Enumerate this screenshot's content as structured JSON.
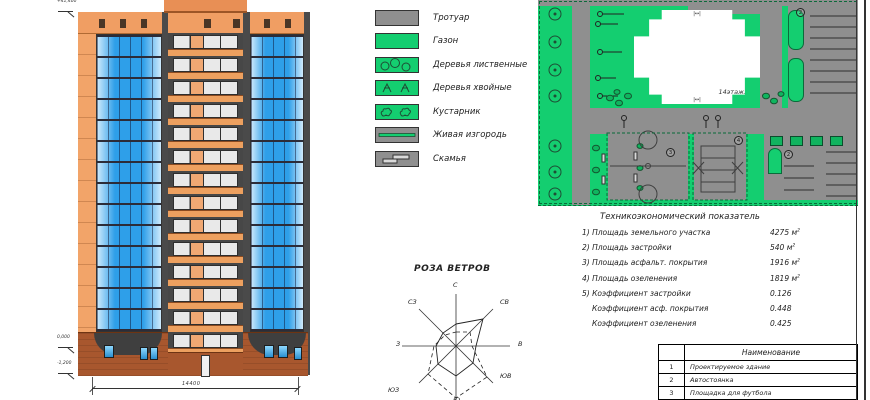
{
  "legend": {
    "items": [
      {
        "label": "Тротуар",
        "type": "sidewalk"
      },
      {
        "label": "Газон",
        "type": "lawn"
      },
      {
        "label": "Деревья лиственные",
        "type": "deciduous-trees"
      },
      {
        "label": "Деревья хвойные",
        "type": "conifer-trees"
      },
      {
        "label": "Кустарник",
        "type": "shrub"
      },
      {
        "label": "Живая изгородь",
        "type": "hedge"
      },
      {
        "label": "Скамья",
        "type": "bench"
      }
    ]
  },
  "site_plan": {
    "building_label": "14этаж.",
    "markers": {
      "parking_upper": "2",
      "parking_lower": "2",
      "field": "3",
      "court": "4"
    }
  },
  "wind_rose": {
    "title": "РОЗА ВЕТРОВ",
    "directions": {
      "n": "С",
      "ne": "СВ",
      "e": "В",
      "se": "ЮВ",
      "s": "Ю",
      "sw": "ЮЗ",
      "w": "З",
      "nw": "СЗ"
    }
  },
  "indicators": {
    "title": "Техникоэкономический показатель",
    "rows": [
      {
        "label": "1) Площадь земельного участка",
        "value": "4275 м",
        "sup": "2"
      },
      {
        "label": "2) Площадь застройки",
        "value": "540 м",
        "sup": "2"
      },
      {
        "label": "3) Площадь асфальт. покрытия",
        "value": "1916 м",
        "sup": "2"
      },
      {
        "label": "4) Площадь озеленения",
        "value": "1819 м",
        "sup": "2"
      },
      {
        "label": "5) Коэффициент застройки",
        "value": "0.126",
        "sup": ""
      },
      {
        "label": "Коэффициент асф. покрытия",
        "value": "0.448",
        "sup": ""
      },
      {
        "label": "Коэффициент озеленения",
        "value": "0.425",
        "sup": ""
      }
    ]
  },
  "schedule_table": {
    "header": "Наименование",
    "rows": [
      {
        "num": "1",
        "name": "Проектируемое здание"
      },
      {
        "num": "2",
        "name": "Автостоянка"
      },
      {
        "num": "3",
        "name": "Площадка для футбола"
      }
    ]
  },
  "elevation": {
    "dimension": "14400",
    "marks": {
      "top": "+41,400",
      "zero": "0,000",
      "below": "-1,200"
    }
  },
  "colors": {
    "facade_orange": "#f2a469",
    "glazing_blue": "#2e9fe9",
    "lawn_green": "#14ce70",
    "path_gray": "#8f8f8f",
    "dark_strip": "#4a4a4a",
    "base_brick": "#a8572e"
  }
}
